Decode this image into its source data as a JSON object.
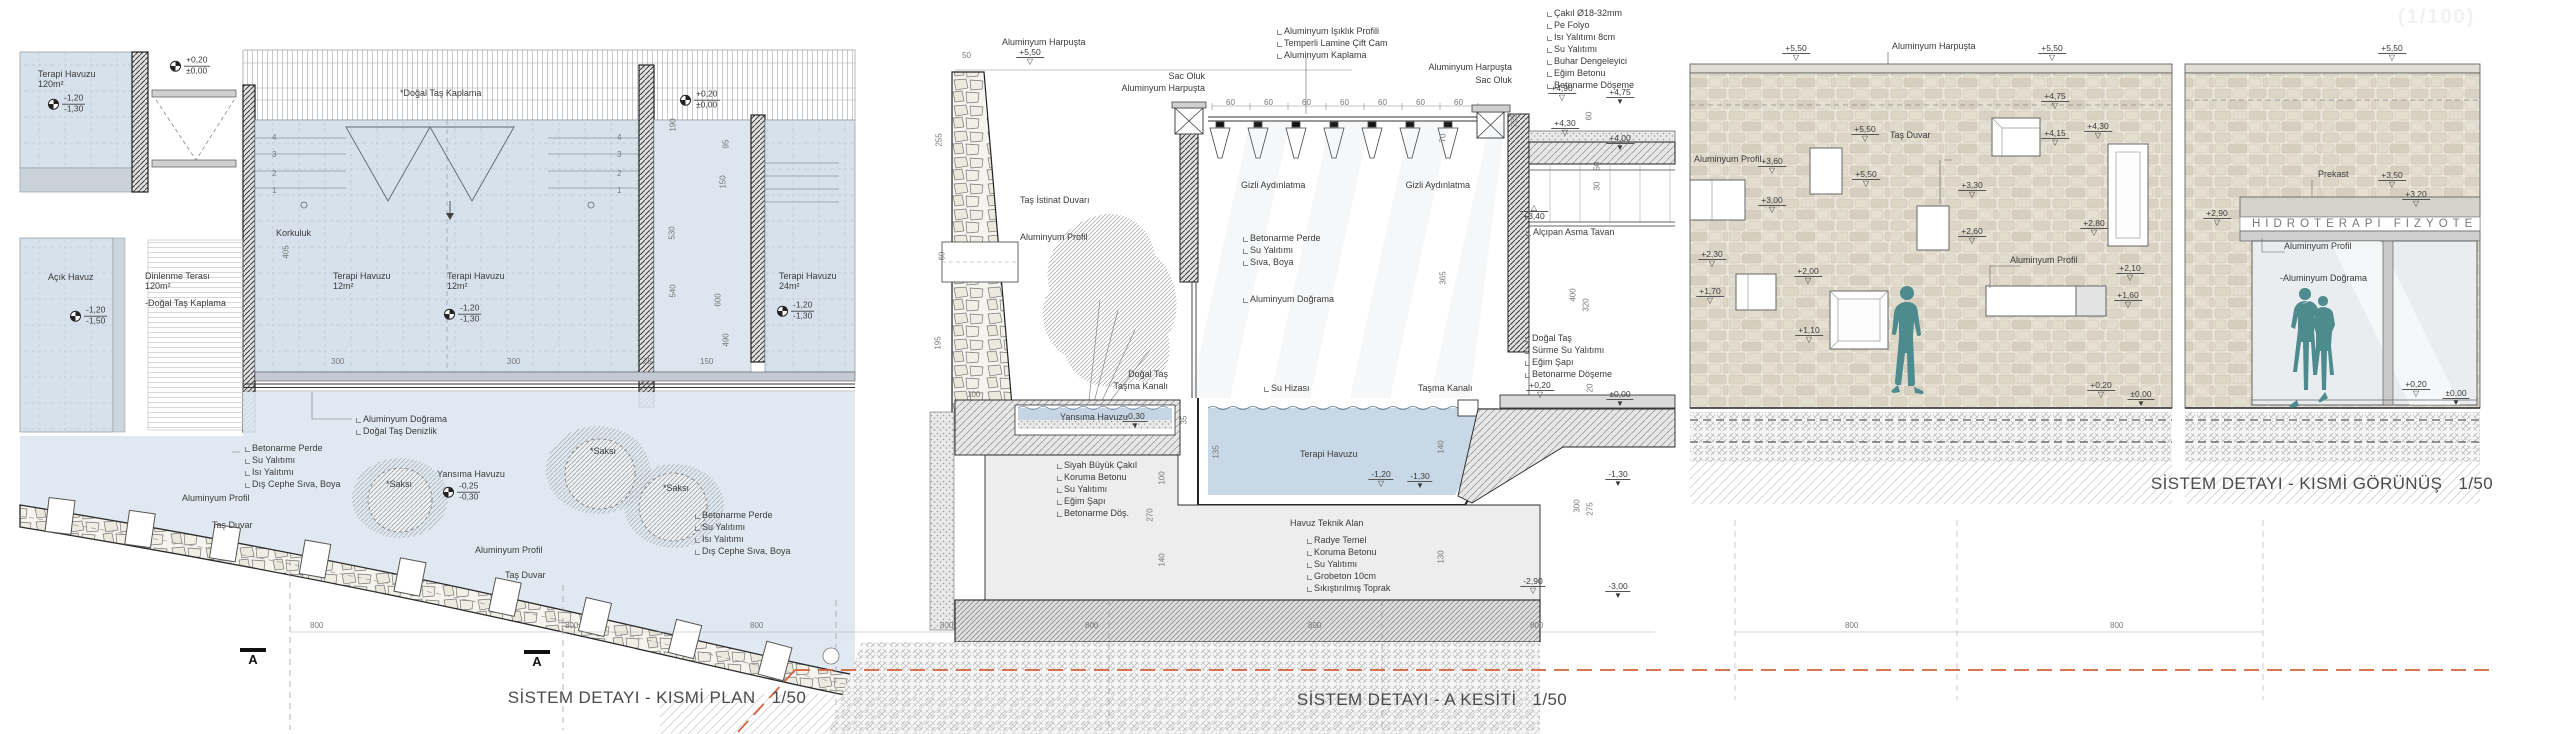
{
  "meta": {
    "watermark": "(1/100)"
  },
  "titles": {
    "plan": "SİSTEM DETAYI - KISMİ PLAN",
    "plan_scale": "1/50",
    "section": "SİSTEM DETAYI - A KESİTİ",
    "section_scale": "1/50",
    "elevation": "SİSTEM DETAYI - KISMİ GÖRÜNÜŞ",
    "elevation_scale": "1/50"
  },
  "elevation": {
    "sign": "HİDROTERAPİ FİZYOTE"
  },
  "annotations": {
    "labels": [
      {
        "t": "Terapi Havuzu",
        "x": 38,
        "y": 70
      },
      {
        "t": "120m²",
        "x": 38,
        "y": 80
      },
      {
        "t": "*Doğal Taş Kaplama",
        "x": 400,
        "y": 89
      },
      {
        "t": "Korkuluk",
        "x": 276,
        "y": 229
      },
      {
        "t": "Açık Havuz",
        "x": 48,
        "y": 273
      },
      {
        "t": "Dinlenme Terası",
        "x": 145,
        "y": 272
      },
      {
        "t": "120m²",
        "x": 145,
        "y": 282
      },
      {
        "t": "-Doğal Taş Kaplama",
        "x": 145,
        "y": 299
      },
      {
        "t": "Terapi Havuzu",
        "x": 333,
        "y": 272
      },
      {
        "t": "12m²",
        "x": 333,
        "y": 282
      },
      {
        "t": "Terapi Havuzu",
        "x": 447,
        "y": 272
      },
      {
        "t": "12m²",
        "x": 447,
        "y": 282
      },
      {
        "t": "Terapi Havuzu",
        "x": 779,
        "y": 272
      },
      {
        "t": "24m²",
        "x": 779,
        "y": 282
      },
      {
        "t": "Aluminyum Doğrama",
        "x": 355,
        "y": 415,
        "s": 1
      },
      {
        "t": "Doğal Taş Denizlik",
        "x": 355,
        "y": 427,
        "s": 1
      },
      {
        "t": "Betonarme Perde",
        "x": 244,
        "y": 444,
        "s": 1
      },
      {
        "t": "Su Yalıtımı",
        "x": 244,
        "y": 456,
        "s": 1
      },
      {
        "t": "Isı Yalıtımı",
        "x": 244,
        "y": 468,
        "s": 1
      },
      {
        "t": "Dış Cephe Sıva, Boya",
        "x": 244,
        "y": 480,
        "s": 1
      },
      {
        "t": "Aluminyum Profil",
        "x": 182,
        "y": 494
      },
      {
        "t": "Taş Duvar",
        "x": 212,
        "y": 521
      },
      {
        "t": "Yansıma Havuzu",
        "x": 437,
        "y": 470
      },
      {
        "t": "*Saksı",
        "x": 386,
        "y": 480
      },
      {
        "t": "*Saksı",
        "x": 590,
        "y": 447
      },
      {
        "t": "*Saksı",
        "x": 663,
        "y": 484
      },
      {
        "t": "Aluminyum Profil",
        "x": 475,
        "y": 546
      },
      {
        "t": "Taş Duvar",
        "x": 505,
        "y": 571
      },
      {
        "t": "Betonarme Perde",
        "x": 694,
        "y": 511,
        "s": 1
      },
      {
        "t": "Su Yalıtımı",
        "x": 694,
        "y": 523,
        "s": 1
      },
      {
        "t": "Isı Yalıtımı",
        "x": 694,
        "y": 535,
        "s": 1
      },
      {
        "t": "Dış Cephe Sıva, Boya",
        "x": 694,
        "y": 547,
        "s": 1
      },
      {
        "t": "Aluminyum Harpuşta",
        "x": 1002,
        "y": 38
      },
      {
        "t": "Sac Oluk",
        "x": 1205,
        "y": 72,
        "r": 1
      },
      {
        "t": "Aluminyum Harpuşta",
        "x": 1205,
        "y": 84,
        "r": 1
      },
      {
        "t": "Aluminyum Işıklık Profili",
        "x": 1276,
        "y": 27,
        "s": 1
      },
      {
        "t": "Temperli Lamine Çift Cam",
        "x": 1276,
        "y": 39,
        "s": 1
      },
      {
        "t": "Aluminyum Kaplama",
        "x": 1276,
        "y": 51,
        "s": 1
      },
      {
        "t": "Aluminyum Harpuşta",
        "x": 1512,
        "y": 63,
        "r": 1
      },
      {
        "t": "Sac Oluk",
        "x": 1512,
        "y": 76,
        "r": 1
      },
      {
        "t": "Çakıl Ø18-32mm",
        "x": 1546,
        "y": 9,
        "s": 1
      },
      {
        "t": "Pe Folyo",
        "x": 1546,
        "y": 21,
        "s": 1
      },
      {
        "t": "Isı Yalıtımı 8cm",
        "x": 1546,
        "y": 33,
        "s": 1
      },
      {
        "t": "Su Yalıtımı",
        "x": 1546,
        "y": 45,
        "s": 1
      },
      {
        "t": "Buhar Dengeleyici",
        "x": 1546,
        "y": 57,
        "s": 1
      },
      {
        "t": "Eğim Betonu",
        "x": 1546,
        "y": 69,
        "s": 1
      },
      {
        "t": "Betonarme Döşeme",
        "x": 1546,
        "y": 81,
        "s": 1
      },
      {
        "t": "Gizli Aydınlatma",
        "x": 1241,
        "y": 181
      },
      {
        "t": "Gizli Aydınlatma",
        "x": 1470,
        "y": 181,
        "r": 1
      },
      {
        "t": "Taş İstinat Duvarı",
        "x": 1020,
        "y": 196
      },
      {
        "t": "Aluminyum Profil",
        "x": 1020,
        "y": 233
      },
      {
        "t": "Betonarme Perde",
        "x": 1242,
        "y": 234,
        "s": 1
      },
      {
        "t": "Su Yalıtımı",
        "x": 1242,
        "y": 246,
        "s": 1
      },
      {
        "t": "Sıva, Boya",
        "x": 1242,
        "y": 258,
        "s": 1
      },
      {
        "t": "Aluminyum Doğrama",
        "x": 1242,
        "y": 295,
        "s": 1
      },
      {
        "t": "Alçıpan Asma Tavan",
        "x": 1525,
        "y": 228,
        "s": 1
      },
      {
        "t": "Doğal Taş",
        "x": 1524,
        "y": 334,
        "s": 1
      },
      {
        "t": "Sürme Su Yalıtımı",
        "x": 1524,
        "y": 346,
        "s": 1
      },
      {
        "t": "Eğim Şapı",
        "x": 1524,
        "y": 358,
        "s": 1
      },
      {
        "t": "Betonarme Döşeme",
        "x": 1524,
        "y": 370,
        "s": 1
      },
      {
        "t": "Doğal Taş",
        "x": 1168,
        "y": 370,
        "r": 1
      },
      {
        "t": "Taşma Kanalı",
        "x": 1168,
        "y": 382,
        "r": 1
      },
      {
        "t": "Su Hizası",
        "x": 1263,
        "y": 384,
        "s": 1
      },
      {
        "t": "Taşma Kanalı",
        "x": 1418,
        "y": 384
      },
      {
        "t": "Yansıma Havuzu",
        "x": 1060,
        "y": 413
      },
      {
        "t": "Terapi Havuzu",
        "x": 1300,
        "y": 450
      },
      {
        "t": "Siyah Büyük Çakıl",
        "x": 1056,
        "y": 461,
        "s": 1
      },
      {
        "t": "Koruma Betonu",
        "x": 1056,
        "y": 473,
        "s": 1
      },
      {
        "t": "Su Yalıtımı",
        "x": 1056,
        "y": 485,
        "s": 1
      },
      {
        "t": "Eğim Şapı",
        "x": 1056,
        "y": 497,
        "s": 1
      },
      {
        "t": "Betonarme Döş.",
        "x": 1056,
        "y": 509,
        "s": 1
      },
      {
        "t": "Havuz Teknik Alan",
        "x": 1290,
        "y": 519
      },
      {
        "t": "Radye Temel",
        "x": 1306,
        "y": 536,
        "s": 1
      },
      {
        "t": "Koruma Betonu",
        "x": 1306,
        "y": 548,
        "s": 1
      },
      {
        "t": "Su Yalıtımı",
        "x": 1306,
        "y": 560,
        "s": 1
      },
      {
        "t": "Grobeton 10cm",
        "x": 1306,
        "y": 572,
        "s": 1
      },
      {
        "t": "Sıkıştırılmış Toprak",
        "x": 1306,
        "y": 584,
        "s": 1
      },
      {
        "t": "Aluminyum Harpuşta",
        "x": 1892,
        "y": 42
      },
      {
        "t": "Aluminyum Profil",
        "x": 1694,
        "y": 155
      },
      {
        "t": "Taş Duvar",
        "x": 1890,
        "y": 131
      },
      {
        "t": "Aluminyum Profil",
        "x": 2010,
        "y": 256
      },
      {
        "t": "Prekast",
        "x": 2318,
        "y": 170
      },
      {
        "t": "Aluminyum Profil",
        "x": 2284,
        "y": 242
      },
      {
        "t": "-Aluminyum Doğrama",
        "x": 2280,
        "y": 274
      }
    ],
    "levels_plan": [
      {
        "a": "-1,20",
        "b": "-1,30",
        "x": 48,
        "y": 104
      },
      {
        "a": "+0,20",
        "b": "±0,00",
        "x": 170,
        "y": 66
      },
      {
        "a": "+0,20",
        "b": "±0,00",
        "x": 680,
        "y": 100
      },
      {
        "a": "-1,20",
        "b": "-1,50",
        "x": 70,
        "y": 316
      },
      {
        "a": "-1,20",
        "b": "-1,30",
        "x": 444,
        "y": 314
      },
      {
        "a": "-1,20",
        "b": "-1,30",
        "x": 777,
        "y": 311
      },
      {
        "a": "-0,25",
        "b": "-0,30",
        "x": 443,
        "y": 492
      }
    ],
    "levels": [
      {
        "v": "+5,50",
        "x": 1030,
        "y": 48,
        "k": "o"
      },
      {
        "v": "+4,90",
        "x": 1562,
        "y": 84,
        "k": "o"
      },
      {
        "v": "+4,75",
        "x": 1620,
        "y": 88,
        "k": "f"
      },
      {
        "v": "+4,30",
        "x": 1565,
        "y": 119,
        "k": "o"
      },
      {
        "v": "+4,00",
        "x": 1620,
        "y": 134,
        "k": "f"
      },
      {
        "v": "+3,40",
        "x": 1534,
        "y": 204,
        "k": "u"
      },
      {
        "v": "+0,20",
        "x": 1540,
        "y": 381,
        "k": "o"
      },
      {
        "v": "±0,00",
        "x": 1620,
        "y": 390,
        "k": "f"
      },
      {
        "v": "-0,30",
        "x": 1135,
        "y": 412,
        "k": "f"
      },
      {
        "v": "-1,20",
        "x": 1381,
        "y": 470,
        "k": "o"
      },
      {
        "v": "-1,30",
        "x": 1420,
        "y": 472,
        "k": "f"
      },
      {
        "v": "-1,30",
        "x": 1618,
        "y": 470,
        "k": "f"
      },
      {
        "v": "-2,90",
        "x": 1533,
        "y": 577,
        "k": "o"
      },
      {
        "v": "-3,00",
        "x": 1618,
        "y": 582,
        "k": "f"
      },
      {
        "v": "+5,50",
        "x": 1796,
        "y": 44,
        "k": "o"
      },
      {
        "v": "+5,50",
        "x": 2052,
        "y": 44,
        "k": "o"
      },
      {
        "v": "+5,50",
        "x": 2392,
        "y": 44,
        "k": "o"
      },
      {
        "v": "+4,75",
        "x": 2055,
        "y": 92,
        "k": "o"
      },
      {
        "v": "+4,15",
        "x": 2055,
        "y": 129,
        "k": "o"
      },
      {
        "v": "+4,30",
        "x": 2098,
        "y": 122,
        "k": "o"
      },
      {
        "v": "+2,80",
        "x": 2094,
        "y": 219,
        "k": "o"
      },
      {
        "v": "+3,60",
        "x": 1772,
        "y": 157,
        "k": "o"
      },
      {
        "v": "+3,00",
        "x": 1772,
        "y": 196,
        "k": "o"
      },
      {
        "v": "+5,50",
        "x": 1865,
        "y": 125,
        "k": "o"
      },
      {
        "v": "+5,50",
        "x": 1866,
        "y": 170,
        "k": "o"
      },
      {
        "v": "+3,30",
        "x": 1972,
        "y": 181,
        "k": "o"
      },
      {
        "v": "+2,60",
        "x": 1972,
        "y": 227,
        "k": "o"
      },
      {
        "v": "+2,30",
        "x": 1712,
        "y": 250,
        "k": "o"
      },
      {
        "v": "+1,70",
        "x": 1710,
        "y": 287,
        "k": "o"
      },
      {
        "v": "+2,00",
        "x": 1808,
        "y": 267,
        "k": "o"
      },
      {
        "v": "+1,10",
        "x": 1809,
        "y": 326,
        "k": "o"
      },
      {
        "v": "+2,10",
        "x": 2130,
        "y": 264,
        "k": "o"
      },
      {
        "v": "+1,60",
        "x": 2128,
        "y": 291,
        "k": "o"
      },
      {
        "v": "+0,20",
        "x": 2101,
        "y": 381,
        "k": "o"
      },
      {
        "v": "±0,00",
        "x": 2141,
        "y": 390,
        "k": "f"
      },
      {
        "v": "+3,50",
        "x": 2392,
        "y": 171,
        "k": "o"
      },
      {
        "v": "+3,20",
        "x": 2416,
        "y": 190,
        "k": "o"
      },
      {
        "v": "+2,90",
        "x": 2217,
        "y": 209,
        "k": "o"
      },
      {
        "v": "+0,20",
        "x": 2416,
        "y": 380,
        "k": "o"
      },
      {
        "v": "±0,00",
        "x": 2456,
        "y": 389,
        "k": "f"
      }
    ],
    "dims": [
      {
        "t": "405",
        "x": 287,
        "y": 252,
        "v": 1
      },
      {
        "t": "190",
        "x": 674,
        "y": 125,
        "v": 1
      },
      {
        "t": "95",
        "x": 727,
        "y": 144,
        "v": 1
      },
      {
        "t": "530",
        "x": 673,
        "y": 233,
        "v": 1
      },
      {
        "t": "150",
        "x": 724,
        "y": 182,
        "v": 1
      },
      {
        "t": "540",
        "x": 674,
        "y": 291,
        "v": 1
      },
      {
        "t": "600",
        "x": 719,
        "y": 300,
        "v": 1
      },
      {
        "t": "490",
        "x": 727,
        "y": 340,
        "v": 1
      },
      {
        "t": "300",
        "x": 331,
        "y": 358
      },
      {
        "t": "300",
        "x": 507,
        "y": 358
      },
      {
        "t": "25",
        "x": 643,
        "y": 358
      },
      {
        "t": "150",
        "x": 700,
        "y": 358
      },
      {
        "t": "4",
        "x": 272,
        "y": 134
      },
      {
        "t": "3",
        "x": 272,
        "y": 151
      },
      {
        "t": "2",
        "x": 272,
        "y": 170
      },
      {
        "t": "1",
        "x": 272,
        "y": 187
      },
      {
        "t": "4",
        "x": 617,
        "y": 134
      },
      {
        "t": "3",
        "x": 617,
        "y": 151
      },
      {
        "t": "2",
        "x": 617,
        "y": 170
      },
      {
        "t": "1",
        "x": 617,
        "y": 187
      },
      {
        "t": "800",
        "x": 310,
        "y": 622
      },
      {
        "t": "800",
        "x": 565,
        "y": 622
      },
      {
        "t": "800",
        "x": 750,
        "y": 622
      },
      {
        "t": "800",
        "x": 940,
        "y": 622
      },
      {
        "t": "800",
        "x": 1085,
        "y": 622
      },
      {
        "t": "800",
        "x": 1308,
        "y": 622
      },
      {
        "t": "800",
        "x": 1530,
        "y": 622
      },
      {
        "t": "800",
        "x": 1845,
        "y": 622
      },
      {
        "t": "800",
        "x": 2110,
        "y": 622
      },
      {
        "t": "50",
        "x": 962,
        "y": 52
      },
      {
        "t": "255",
        "x": 940,
        "y": 140,
        "v": 1
      },
      {
        "t": "60",
        "x": 943,
        "y": 256,
        "v": 1
      },
      {
        "t": "195",
        "x": 939,
        "y": 343,
        "v": 1
      },
      {
        "t": "100",
        "x": 967,
        "y": 391
      },
      {
        "t": "60",
        "x": 1226,
        "y": 99
      },
      {
        "t": "60",
        "x": 1264,
        "y": 99
      },
      {
        "t": "60",
        "x": 1302,
        "y": 99
      },
      {
        "t": "60",
        "x": 1340,
        "y": 99
      },
      {
        "t": "60",
        "x": 1378,
        "y": 99
      },
      {
        "t": "60",
        "x": 1416,
        "y": 99
      },
      {
        "t": "60",
        "x": 1454,
        "y": 99
      },
      {
        "t": "70",
        "x": 1444,
        "y": 138,
        "v": 1
      },
      {
        "t": "365",
        "x": 1444,
        "y": 278,
        "v": 1
      },
      {
        "t": "225",
        "x": 1515,
        "y": 120,
        "v": 1
      },
      {
        "t": "60",
        "x": 1590,
        "y": 116,
        "v": 1
      },
      {
        "t": "50",
        "x": 1598,
        "y": 166,
        "v": 1
      },
      {
        "t": "30",
        "x": 1598,
        "y": 186,
        "v": 1
      },
      {
        "t": "400",
        "x": 1574,
        "y": 295,
        "v": 1
      },
      {
        "t": "320",
        "x": 1587,
        "y": 305,
        "v": 1
      },
      {
        "t": "20",
        "x": 1591,
        "y": 388,
        "v": 1
      },
      {
        "t": "35",
        "x": 1185,
        "y": 420,
        "v": 1
      },
      {
        "t": "135",
        "x": 1217,
        "y": 452,
        "v": 1
      },
      {
        "t": "100",
        "x": 1163,
        "y": 478,
        "v": 1
      },
      {
        "t": "270",
        "x": 1151,
        "y": 515,
        "v": 1
      },
      {
        "t": "140",
        "x": 1163,
        "y": 560,
        "v": 1
      },
      {
        "t": "140",
        "x": 1442,
        "y": 447,
        "v": 1
      },
      {
        "t": "130",
        "x": 1442,
        "y": 557,
        "v": 1
      },
      {
        "t": "300",
        "x": 1578,
        "y": 506,
        "v": 1
      },
      {
        "t": "275",
        "x": 1591,
        "y": 509,
        "v": 1
      }
    ],
    "markers": [
      {
        "t": "A",
        "x": 253,
        "y": 648
      },
      {
        "t": "A",
        "x": 537,
        "y": 650
      }
    ]
  }
}
